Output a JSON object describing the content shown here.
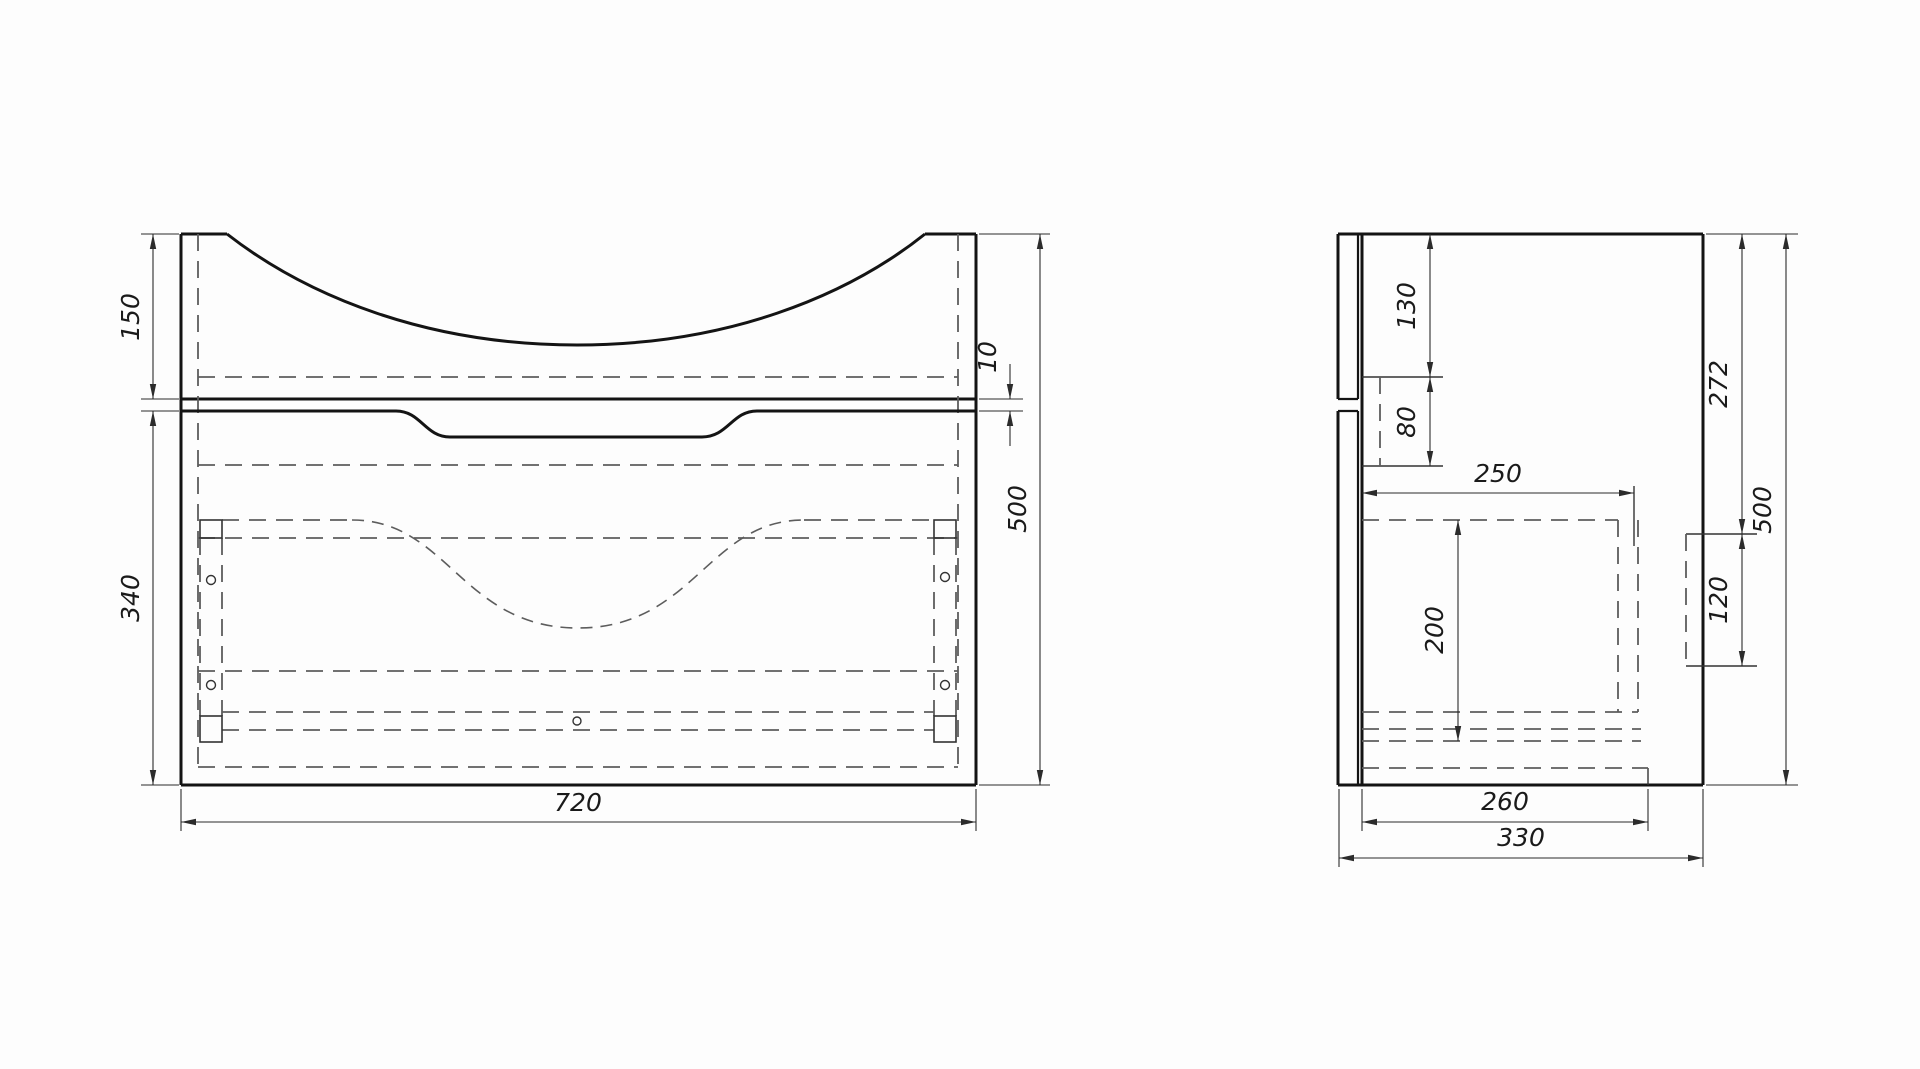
{
  "drawing": {
    "canvas": {
      "width": 1920,
      "height": 1069,
      "background": "#fdfdfd"
    },
    "views": [
      {
        "id": "front-view",
        "width_label": "720",
        "height_label": "500"
      },
      {
        "id": "side-view",
        "width_label": "330",
        "height_label": "500"
      }
    ],
    "styles": {
      "solid": {
        "color": "#141414",
        "width": 3,
        "name": "visible-edge"
      },
      "medium": {
        "color": "#141414",
        "width": 2.2,
        "name": "visible-edge"
      },
      "thin": {
        "color": "#333333",
        "width": 1.4,
        "name": "thin-edge"
      },
      "dim": {
        "color": "#2b2b2b",
        "width": 1.1,
        "name": "dimension-line"
      },
      "dash": {
        "color": "#5d5d5d",
        "width": 1.8,
        "dash": "17 10",
        "name": "hidden-line"
      },
      "dash2": {
        "color": "#5d5d5d",
        "width": 1.6,
        "dash": "12 8",
        "name": "hidden-line"
      },
      "label": {
        "size": 25
      }
    },
    "lines": [
      {
        "v": "front-view",
        "t": "solid",
        "p": [
          181,
          234,
          181,
          785
        ],
        "n": "front-left-edge"
      },
      {
        "v": "front-view",
        "t": "solid",
        "p": [
          181,
          785,
          976,
          785
        ],
        "n": "front-bottom-edge"
      },
      {
        "v": "front-view",
        "t": "solid",
        "p": [
          976,
          234,
          976,
          785
        ],
        "n": "front-right-edge"
      },
      {
        "v": "front-view",
        "t": "solid",
        "p": [
          181,
          234,
          227,
          234
        ],
        "n": "front-top-left-edge"
      },
      {
        "v": "front-view",
        "t": "solid",
        "p": [
          925,
          234,
          976,
          234
        ],
        "n": "front-top-right-edge"
      },
      {
        "v": "front-view",
        "t": "solid",
        "p": [
          181,
          399,
          976,
          399
        ],
        "n": "countertop-bottom-edge"
      },
      {
        "v": "front-view",
        "t": "dash",
        "p": [
          198,
          234,
          198,
          767
        ],
        "n": "side-panel-inner-hidden"
      },
      {
        "v": "front-view",
        "t": "dash",
        "p": [
          958,
          234,
          958,
          767
        ],
        "n": "side-panel-inner-hidden"
      },
      {
        "v": "front-view",
        "t": "dash",
        "p": [
          198,
          377,
          958,
          377
        ],
        "n": "rail-top-hidden"
      },
      {
        "v": "front-view",
        "t": "dash",
        "p": [
          198,
          465,
          958,
          465
        ],
        "n": "interior-hidden"
      },
      {
        "v": "front-view",
        "t": "dash",
        "p": [
          222,
          520,
          352,
          520
        ],
        "n": "drawer-top-hidden"
      },
      {
        "v": "front-view",
        "t": "dash",
        "p": [
          804,
          520,
          934,
          520
        ],
        "n": "drawer-top-hidden"
      },
      {
        "v": "front-view",
        "t": "dash",
        "p": [
          198,
          538,
          958,
          538
        ],
        "n": "interior-hidden"
      },
      {
        "v": "front-view",
        "t": "dash",
        "p": [
          198,
          671,
          958,
          671
        ],
        "n": "drawer-bottom-hidden"
      },
      {
        "v": "front-view",
        "t": "dash",
        "p": [
          222,
          712,
          934,
          712
        ],
        "n": "bottom-panel-hidden"
      },
      {
        "v": "front-view",
        "t": "dash",
        "p": [
          222,
          730,
          934,
          730
        ],
        "n": "bottom-panel-hidden"
      },
      {
        "v": "front-view",
        "t": "dash",
        "p": [
          198,
          767,
          958,
          767
        ],
        "n": "interior-hidden"
      },
      {
        "v": "front-view",
        "t": "dash",
        "p": [
          200,
          538,
          200,
          716
        ],
        "n": "bracket-hidden"
      },
      {
        "v": "front-view",
        "t": "dash",
        "p": [
          222,
          538,
          222,
          716
        ],
        "n": "bracket-hidden"
      },
      {
        "v": "front-view",
        "t": "dash",
        "p": [
          934,
          538,
          934,
          716
        ],
        "n": "bracket-hidden"
      },
      {
        "v": "front-view",
        "t": "dash",
        "p": [
          956,
          538,
          956,
          716
        ],
        "n": "bracket-hidden"
      },
      {
        "v": "side-view",
        "t": "solid",
        "p": [
          1338,
          234,
          1703,
          234
        ],
        "n": "side-top-edge"
      },
      {
        "v": "side-view",
        "t": "solid",
        "p": [
          1338,
          785,
          1703,
          785
        ],
        "n": "side-bottom-edge"
      },
      {
        "v": "side-view",
        "t": "solid",
        "p": [
          1703,
          234,
          1703,
          785
        ],
        "n": "side-back-edge"
      },
      {
        "v": "side-view",
        "t": "solid",
        "p": [
          1362,
          234,
          1362,
          785
        ],
        "n": "carcass-front-edge"
      },
      {
        "v": "side-view",
        "t": "solid",
        "p": [
          1338,
          234,
          1338,
          399
        ],
        "n": "facade-front-edge-upper"
      },
      {
        "v": "side-view",
        "t": "solid",
        "p": [
          1338,
          411,
          1338,
          785
        ],
        "n": "facade-front-edge-lower"
      },
      {
        "v": "side-view",
        "t": "medium",
        "p": [
          1358,
          234,
          1358,
          399
        ],
        "n": "facade-back-edge-upper"
      },
      {
        "v": "side-view",
        "t": "medium",
        "p": [
          1358,
          411,
          1358,
          785
        ],
        "n": "facade-back-edge-lower"
      },
      {
        "v": "side-view",
        "t": "medium",
        "p": [
          1338,
          399,
          1358,
          399
        ],
        "n": "facade-groove-edge"
      },
      {
        "v": "side-view",
        "t": "medium",
        "p": [
          1338,
          411,
          1358,
          411
        ],
        "n": "facade-groove-edge"
      },
      {
        "v": "side-view",
        "t": "thin",
        "p": [
          1362,
          377,
          1443,
          377
        ],
        "n": "hanging-rail-top"
      },
      {
        "v": "side-view",
        "t": "thin",
        "p": [
          1362,
          466,
          1443,
          466
        ],
        "n": "hanging-rail-bottom"
      },
      {
        "v": "side-view",
        "t": "thin",
        "p": [
          1686,
          534,
          1757,
          534
        ],
        "n": "wall-bracket-top"
      },
      {
        "v": "side-view",
        "t": "thin",
        "p": [
          1686,
          666,
          1757,
          666
        ],
        "n": "wall-bracket-bottom"
      },
      {
        "v": "side-view",
        "t": "thin",
        "p": [
          1648,
          768,
          1648,
          785
        ],
        "n": "bottom-recess-step"
      },
      {
        "v": "side-view",
        "t": "thin",
        "p": [
          1634,
          486,
          1634,
          546
        ],
        "n": "extension-line"
      },
      {
        "v": "side-view",
        "t": "dash",
        "p": [
          1380,
          377,
          1380,
          466
        ],
        "n": "hanging-rail-hidden"
      },
      {
        "v": "side-view",
        "t": "dash",
        "p": [
          1362,
          520,
          1618,
          520
        ],
        "n": "drawer-top-hidden"
      },
      {
        "v": "side-view",
        "t": "dash",
        "p": [
          1618,
          520,
          1618,
          712
        ],
        "n": "drawer-back-hidden"
      },
      {
        "v": "side-view",
        "t": "dash",
        "p": [
          1638,
          520,
          1638,
          712
        ],
        "n": "drawer-back-hidden"
      },
      {
        "v": "side-view",
        "t": "dash",
        "p": [
          1362,
          712,
          1638,
          712
        ],
        "n": "drawer-bottom-hidden"
      },
      {
        "v": "side-view",
        "t": "dash",
        "p": [
          1362,
          729,
          1641,
          729
        ],
        "n": "bottom-panel-hidden"
      },
      {
        "v": "side-view",
        "t": "dash",
        "p": [
          1362,
          741,
          1641,
          741
        ],
        "n": "bottom-panel-hidden"
      },
      {
        "v": "side-view",
        "t": "dash",
        "p": [
          1362,
          768,
          1648,
          768
        ],
        "n": "bottom-recess-hidden"
      },
      {
        "v": "side-view",
        "t": "dash",
        "p": [
          1686,
          534,
          1686,
          666
        ],
        "n": "wall-bracket-hidden"
      }
    ],
    "paths": [
      {
        "v": "front-view",
        "t": "solid",
        "n": "basin-top-curve",
        "d": "M227,234 C308,297 428,345 577,345 C726,345 846,297 925,234"
      },
      {
        "v": "front-view",
        "t": "solid",
        "n": "drawer-top-with-handle-recess",
        "d": "M181,411 L396,411 C421,411 425,437 450,437 L702,437 C728,437 732,411 757,411 L976,411"
      },
      {
        "v": "front-view",
        "t": "dash2",
        "n": "basin-bowl-hidden-curve",
        "d": "M352,520 C448,520 462,628 578,628 C694,628 708,520 804,520"
      }
    ],
    "rects": [
      {
        "v": "front-view",
        "n": "bracket-block",
        "p": [
          200,
          520,
          22,
          18
        ]
      },
      {
        "v": "front-view",
        "n": "bracket-block",
        "p": [
          200,
          716,
          22,
          26
        ]
      },
      {
        "v": "front-view",
        "n": "bracket-block",
        "p": [
          934,
          520,
          22,
          18
        ]
      },
      {
        "v": "front-view",
        "n": "bracket-block",
        "p": [
          934,
          716,
          22,
          26
        ]
      }
    ],
    "circles": [
      {
        "v": "front-view",
        "n": "fastener-hole",
        "p": [
          211,
          580,
          4.5
        ]
      },
      {
        "v": "front-view",
        "n": "fastener-hole",
        "p": [
          211,
          685,
          4.5
        ]
      },
      {
        "v": "front-view",
        "n": "fastener-hole",
        "p": [
          945,
          577,
          4.5
        ]
      },
      {
        "v": "front-view",
        "n": "fastener-hole",
        "p": [
          945,
          685,
          4.5
        ]
      },
      {
        "v": "front-view",
        "n": "center-hole",
        "p": [
          577,
          721,
          4
        ]
      }
    ],
    "ext_lines": [
      {
        "v": "front-view",
        "p": [
          141,
          234,
          179,
          234
        ]
      },
      {
        "v": "front-view",
        "p": [
          141,
          399,
          179,
          399
        ]
      },
      {
        "v": "front-view",
        "p": [
          141,
          411,
          179,
          411
        ]
      },
      {
        "v": "front-view",
        "p": [
          141,
          785,
          179,
          785
        ]
      },
      {
        "v": "front-view",
        "p": [
          181,
          789,
          181,
          831
        ]
      },
      {
        "v": "front-view",
        "p": [
          976,
          789,
          976,
          831
        ]
      },
      {
        "v": "front-view",
        "p": [
          979,
          399,
          1023,
          399
        ]
      },
      {
        "v": "front-view",
        "p": [
          979,
          411,
          1023,
          411
        ]
      },
      {
        "v": "front-view",
        "p": [
          979,
          234,
          1050,
          234
        ]
      },
      {
        "v": "front-view",
        "p": [
          979,
          785,
          1050,
          785
        ]
      },
      {
        "v": "side-view",
        "p": [
          1706,
          234,
          1798,
          234
        ]
      },
      {
        "v": "side-view",
        "p": [
          1706,
          785,
          1798,
          785
        ]
      },
      {
        "v": "side-view",
        "p": [
          1362,
          789,
          1362,
          831
        ]
      },
      {
        "v": "side-view",
        "p": [
          1648,
          789,
          1648,
          831
        ]
      },
      {
        "v": "side-view",
        "p": [
          1339,
          789,
          1339,
          867
        ]
      },
      {
        "v": "side-view",
        "p": [
          1703,
          789,
          1703,
          867
        ]
      }
    ],
    "dims": [
      {
        "id": "150",
        "v": "front-view",
        "label": "150",
        "lines": [
          [
            153,
            234,
            153,
            399,
            1,
            1
          ]
        ],
        "lx": 139,
        "ly": 317,
        "rot": true
      },
      {
        "id": "340",
        "v": "front-view",
        "label": "340",
        "lines": [
          [
            153,
            411,
            153,
            785,
            1,
            1
          ]
        ],
        "lx": 139,
        "ly": 598,
        "rot": true
      },
      {
        "id": "720",
        "v": "front-view",
        "label": "720",
        "lines": [
          [
            181,
            822,
            976,
            822,
            1,
            1
          ]
        ],
        "lx": 578,
        "ly": 811,
        "rot": false
      },
      {
        "id": "10",
        "v": "front-view",
        "label": "10",
        "lines": [
          [
            1010,
            364,
            1010,
            399,
            0,
            1
          ],
          [
            1010,
            446,
            1010,
            411,
            0,
            1
          ]
        ],
        "lx": 996,
        "ly": 357,
        "rot": true
      },
      {
        "id": "500-front",
        "v": "front-view",
        "label": "500",
        "lines": [
          [
            1040,
            234,
            1040,
            785,
            1,
            1
          ]
        ],
        "lx": 1026,
        "ly": 509,
        "rot": true
      },
      {
        "id": "130",
        "v": "side-view",
        "label": "130",
        "lines": [
          [
            1430,
            234,
            1430,
            377,
            1,
            1
          ]
        ],
        "lx": 1415,
        "ly": 306,
        "rot": true
      },
      {
        "id": "80",
        "v": "side-view",
        "label": "80",
        "lines": [
          [
            1430,
            377,
            1430,
            466,
            1,
            1
          ]
        ],
        "lx": 1415,
        "ly": 422,
        "rot": true
      },
      {
        "id": "250",
        "v": "side-view",
        "label": "250",
        "lines": [
          [
            1362,
            493,
            1634,
            493,
            1,
            1
          ]
        ],
        "lx": 1498,
        "ly": 482,
        "rot": false
      },
      {
        "id": "200",
        "v": "side-view",
        "label": "200",
        "lines": [
          [
            1458,
            520,
            1458,
            741,
            1,
            1
          ]
        ],
        "lx": 1443,
        "ly": 630,
        "rot": true
      },
      {
        "id": "272",
        "v": "side-view",
        "label": "272",
        "lines": [
          [
            1742,
            234,
            1742,
            534,
            1,
            1
          ]
        ],
        "lx": 1727,
        "ly": 384,
        "rot": true
      },
      {
        "id": "120",
        "v": "side-view",
        "label": "120",
        "lines": [
          [
            1742,
            534,
            1742,
            666,
            1,
            1
          ]
        ],
        "lx": 1727,
        "ly": 600,
        "rot": true
      },
      {
        "id": "500-side",
        "v": "side-view",
        "label": "500",
        "lines": [
          [
            1786,
            234,
            1786,
            785,
            1,
            1
          ]
        ],
        "lx": 1771,
        "ly": 510,
        "rot": true
      },
      {
        "id": "260",
        "v": "side-view",
        "label": "260",
        "lines": [
          [
            1362,
            822,
            1648,
            822,
            1,
            1
          ]
        ],
        "lx": 1505,
        "ly": 810,
        "rot": false
      },
      {
        "id": "330",
        "v": "side-view",
        "label": "330",
        "lines": [
          [
            1339,
            858,
            1703,
            858,
            1,
            1
          ]
        ],
        "lx": 1521,
        "ly": 846,
        "rot": false
      }
    ]
  }
}
